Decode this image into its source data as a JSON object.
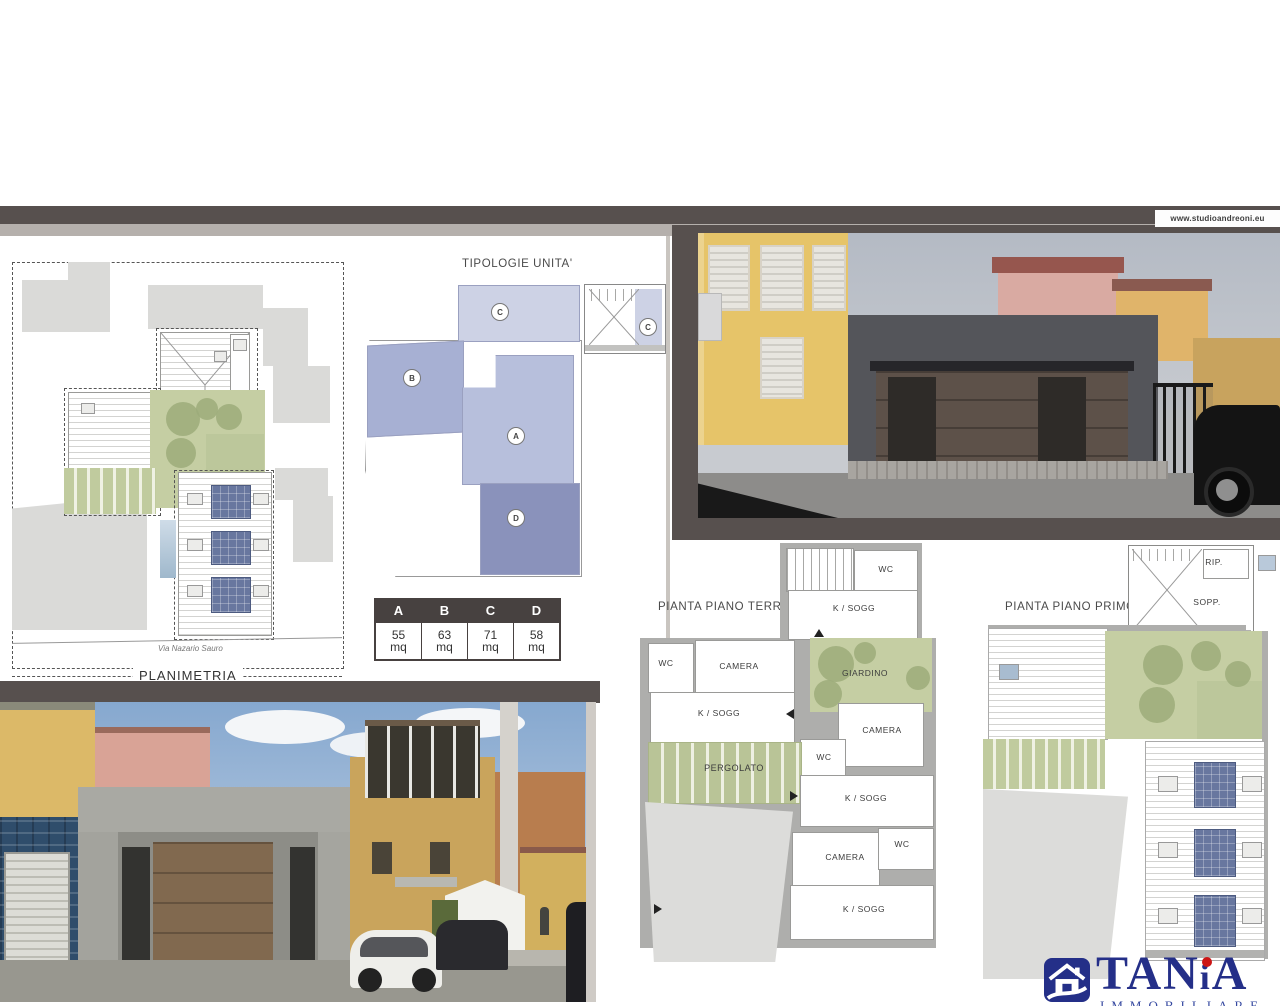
{
  "watermark": {
    "text": "www.studioandreoni.eu"
  },
  "site_plan": {
    "title": "PLANIMETRIA",
    "street": "Via Nazario Sauro"
  },
  "typologies": {
    "title": "TIPOLOGIE UNITA'",
    "units": [
      {
        "letter": "A",
        "color": "#b7bfdc"
      },
      {
        "letter": "B",
        "color": "#a7b0d3"
      },
      {
        "letter": "C",
        "color": "#cdd2e5"
      },
      {
        "letter": "D",
        "color": "#8a92bb"
      }
    ],
    "stair_unit_letter": "C"
  },
  "area_table": {
    "columns": [
      {
        "name": "A",
        "area": "55",
        "unit": "mq"
      },
      {
        "name": "B",
        "area": "63",
        "unit": "mq"
      },
      {
        "name": "C",
        "area": "71",
        "unit": "mq"
      },
      {
        "name": "D",
        "area": "58",
        "unit": "mq"
      }
    ]
  },
  "floor_plans": {
    "terra": {
      "title": "PIANTA PIANO TERRA",
      "rooms": [
        "WC",
        "K / SOGG",
        "WC",
        "CAMERA",
        "K / SOGG",
        "GIARDINO",
        "CAMERA",
        "WC",
        "PERGOLATO",
        "K / SOGG",
        "CAMERA",
        "WC",
        "K / SOGG"
      ]
    },
    "primo": {
      "title": "PIANTA PIANO PRIMO",
      "rooms": [
        "RIP.",
        "SOPP."
      ]
    }
  },
  "agency_logo": {
    "name_t": "TAN",
    "name_i": "i",
    "name_a": "A",
    "subtitle": "IMMOBILIARE",
    "brand_blue": "#242f88",
    "dot_red": "#cc1515"
  },
  "colors": {
    "frame_dark": "#57504e",
    "frame_light": "#b5b0ac",
    "plan_green": "#c5cea3",
    "solar_panel_blue": "#68779f",
    "table_header": "#474140"
  }
}
